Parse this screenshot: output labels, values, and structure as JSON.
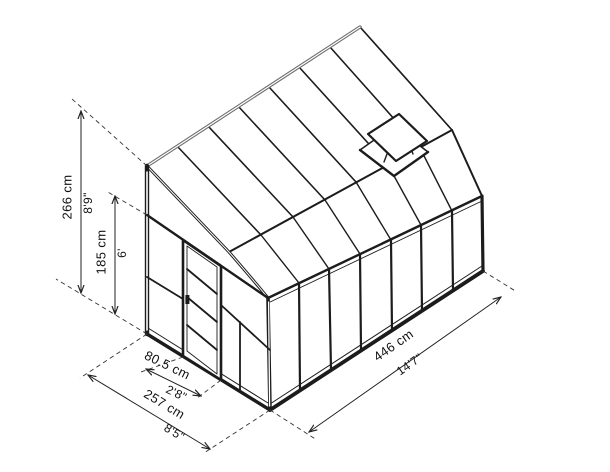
{
  "diagram": {
    "type": "isometric-dimension-drawing",
    "subject": "greenhouse sun room with barn roof, door and roof vent",
    "colors": {
      "line": "#1c1c1c",
      "beam_gray": "#6e6e6e",
      "dimension_line": "#222222",
      "background": "#ffffff"
    },
    "dimensions": {
      "total_height": {
        "metric": "266 cm",
        "imperial": "8'9\""
      },
      "wall_height": {
        "metric": "185 cm",
        "imperial": "6'"
      },
      "door_width": {
        "metric": "80.5 cm",
        "imperial": "2'8\""
      },
      "front_width": {
        "metric": "257 cm",
        "imperial": "8'5\""
      },
      "side_length": {
        "metric": "446 cm",
        "imperial": "14'7\""
      }
    }
  }
}
